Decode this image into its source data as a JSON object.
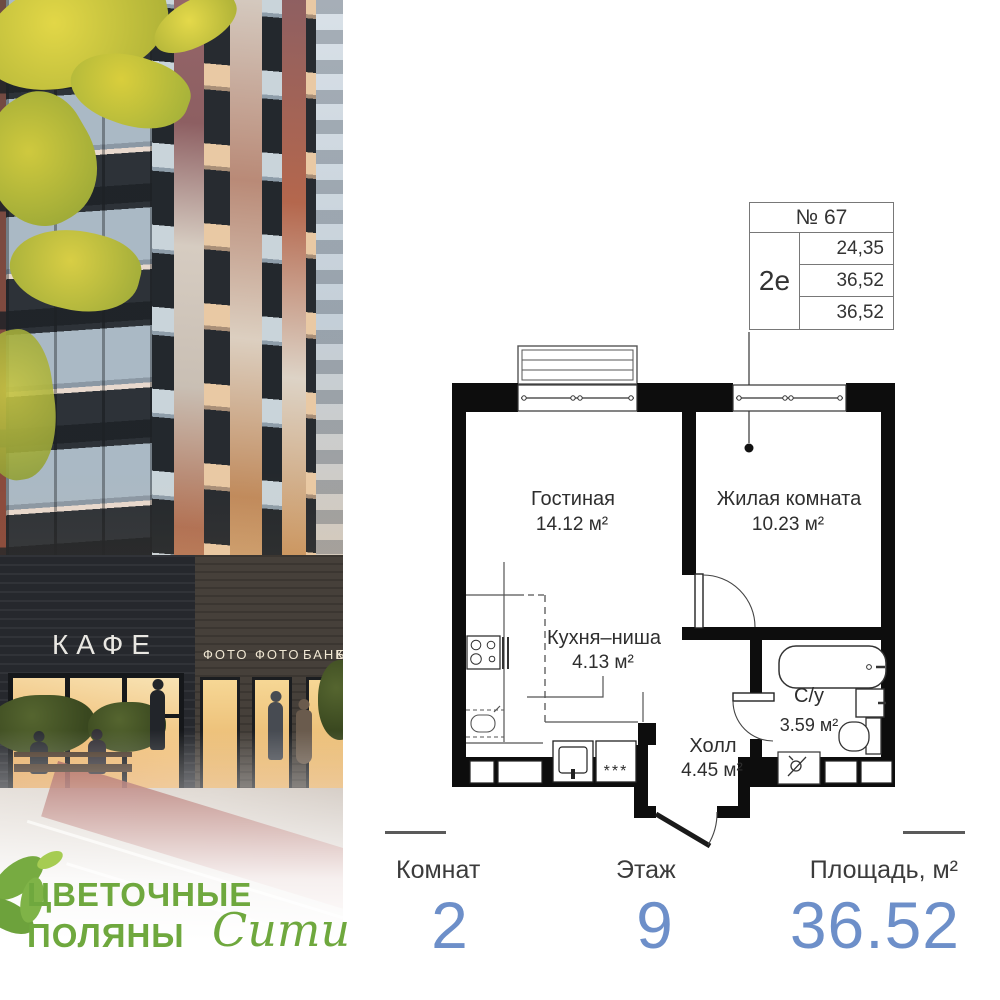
{
  "branding": {
    "name_line1": "ЦВЕТОЧНЫЕ",
    "name_line2": "ПОЛЯНЫ",
    "name_script": "Сити",
    "brand_green": "#6fa83e"
  },
  "photo": {
    "cafe_sign": "КАФЕ",
    "shop_signs": [
      "ФОТО",
      "ФОТО",
      "БАНК",
      "БАНК"
    ]
  },
  "info_box": {
    "apartment_number": "№ 67",
    "apartment_type": "2е",
    "area_rows": [
      "24,35",
      "36,52",
      "36,52"
    ]
  },
  "plan": {
    "rooms": [
      {
        "name": "Гостиная",
        "area": "14.12 м²"
      },
      {
        "name": "Жилая комната",
        "area": "10.23 м²"
      },
      {
        "name": "Кухня–ниша",
        "area": "4.13 м²"
      },
      {
        "name": "Холл",
        "area": "4.45 м²"
      },
      {
        "name": "С/у",
        "area": "3.59 м²"
      }
    ],
    "stars_marker": "***"
  },
  "stats": {
    "value_color": "#6d8fc9",
    "columns": [
      {
        "label": "Комнат",
        "value": "2"
      },
      {
        "label": "Этаж",
        "value": "9"
      },
      {
        "label": "Площадь, м²",
        "value": "36.52"
      }
    ]
  }
}
